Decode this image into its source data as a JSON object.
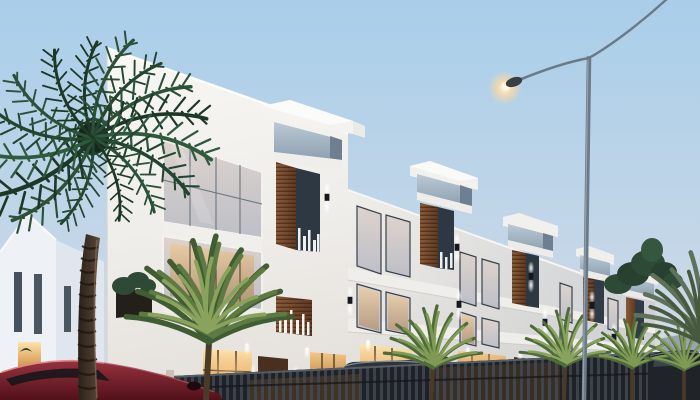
{
  "meta": {
    "description": "Dusk architectural rendering of a modern three-storey white terraced residential development with wood-slat accent panels, glowing warm interior lights, a tall palm tree on the left, small palms and a dark perimeter fence along the street, parked cars and a lit street lamp against a pale blue evening sky.",
    "time_of_day": "dusk",
    "image_type": "3d-architectural-render"
  },
  "palette": {
    "sky_top": "#a9cee9",
    "sky_mid": "#c3d6e8",
    "sky_horizon": "#dadce2",
    "facade_light": "#f7f6f3",
    "facade_mid": "#e9e7e2",
    "facade_shadow": "#d8d9da",
    "wood_accent": "#7d4e2e",
    "wood_dark": "#58351d",
    "glass_cool": "#a9b9c7",
    "glass_dark": "#2e3842",
    "glass_dusk": "#d6ccc8",
    "window_warm": "#f3c887",
    "window_warm_deep": "#b97f3f",
    "door_brown": "#4a2f1e",
    "fence_dark": "#1f2227",
    "wall_cream": "#d8d1c4",
    "car_red": "#84232e",
    "vehicle_dark": "#24282e",
    "palm_dark": "#1d3826",
    "palm_mid": "#2c5038",
    "small_palm_light": "#7f9a52",
    "trunk_brown": "#3a2e24",
    "pole_gray": "#6b7a88",
    "lamp_glow": "#ffd9a0",
    "greenery": "#2e4a36",
    "distant_building": "#97a3b0"
  },
  "scene": {
    "sky": {
      "condition": "clear dusk gradient"
    },
    "street_lamp": {
      "state": "on",
      "arms": 2,
      "position": "right"
    },
    "main_building": {
      "storeys": 3,
      "units_visible": 5,
      "style": "modern white with wood slat columns and protruding glass roof boxes",
      "ground_floor_lights": "warm on"
    },
    "background_buildings": [
      {
        "side": "left",
        "type": "white gable house",
        "windows_lit": 1
      },
      {
        "side": "right",
        "type": "distant gray building"
      }
    ],
    "vegetation": {
      "large_palm": 1,
      "small_palms": 5,
      "rooftop_greenery": true,
      "right_edge_fronds": true
    },
    "vehicles": [
      {
        "type": "sedan",
        "color_name": "red",
        "position": "bottom-left"
      },
      {
        "type": "van",
        "color_name": "dark-gray",
        "position": "center-left behind fence"
      },
      {
        "type": "sedan",
        "color_name": "dark",
        "position": "bottom-center behind fence"
      },
      {
        "type": "suv",
        "color_name": "dark",
        "position": "bottom-right"
      }
    ],
    "fence": {
      "style": "dark vertical bars with cream pier wall",
      "lit_from_behind": true
    },
    "wall_sconces": {
      "count": 10,
      "state": "on"
    },
    "downlights": {
      "count": 9,
      "state": "on"
    }
  }
}
